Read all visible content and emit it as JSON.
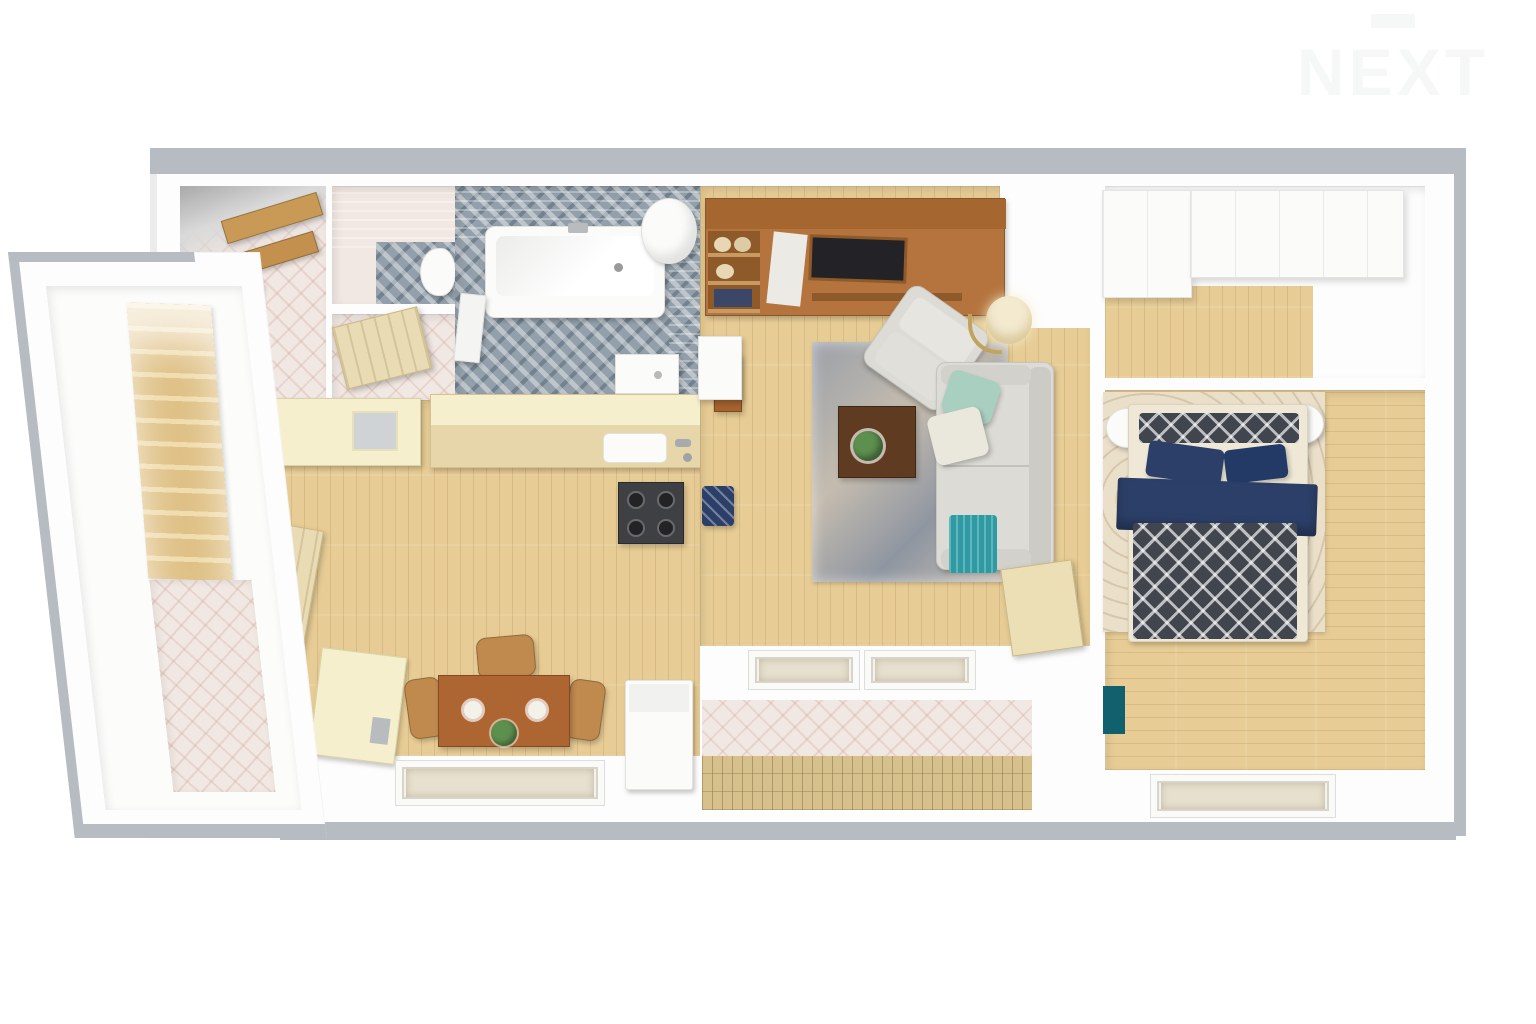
{
  "watermark": {
    "text": "NEXT"
  },
  "palette": {
    "canvas": "#ffffff",
    "wall": "#fdfdfd",
    "outer_edge": "#b6bcc1",
    "wood_floor": "#e7cc95",
    "wood_furn": "#b5743e",
    "cream_cabinet": "#f5efcd",
    "gray_tile": "#93a0ab",
    "gray_wall_tile": "#c3c9cd",
    "pink_tile": "#f2e8e3",
    "sofa_gray": "#dcdbd5",
    "mint": "#a9cfc0",
    "teal": "#2e9aa3",
    "navy": "#2c3f68",
    "dark_blanket": "#41454e",
    "rug_bedroom": "#eadfc9",
    "white_furn": "#fbfbfa",
    "lamp_glow": "#f3ead0",
    "plant_green": "#5d8f4e",
    "stove_dark": "#3f4043",
    "decking": "#d6c08b",
    "door_wood": "#e9dcb4",
    "watermark": "#f6f7f7"
  },
  "scene": {
    "type": "3d-floor-plan-render-top-down",
    "rooms": [
      {
        "id": "stair-hall",
        "label": "Staircase hall",
        "features": [
          "wooden staircase",
          "tiled landing floor"
        ]
      },
      {
        "id": "landing",
        "label": "Upstairs landing",
        "features": [
          "wooden balustrade"
        ]
      },
      {
        "id": "wc",
        "label": "WC",
        "features": [
          "toilet",
          "mosaic floor",
          "gray tiled wall"
        ]
      },
      {
        "id": "storage",
        "label": "Storage closet",
        "features": [
          "open wooden door",
          "pale tiled floor"
        ]
      },
      {
        "id": "bathroom",
        "label": "Bathroom",
        "features": [
          "bathtub",
          "round water heater",
          "shower basin",
          "gray mosaic floor",
          "white door"
        ]
      },
      {
        "id": "kitchen",
        "label": "Kitchen / dining room",
        "features": [
          "cream upper cabinets",
          "counter with sink and faucet",
          "four-burner stove",
          "wooden dining table",
          "three wicker chairs",
          "plates",
          "plant centerpiece",
          "cream fridge unit",
          "white washing machine",
          "entry door",
          "roof window"
        ]
      },
      {
        "id": "living-room",
        "label": "Living room",
        "features": [
          "wooden tv wall unit",
          "flat tv",
          "storage baskets",
          "gray sofa",
          "mint pillow",
          "cream pillow",
          "teal throw",
          "gray armchair",
          "dark coffee table with plant",
          "mottled rug",
          "floor lamp",
          "white desk with wooden chair",
          "navy pouf",
          "balcony door",
          "two roof windows"
        ]
      },
      {
        "id": "balcony",
        "label": "Balcony / loggia",
        "features": [
          "diamond tiled wall",
          "wooden decking"
        ]
      },
      {
        "id": "wardrobe",
        "label": "Walk-in closet",
        "features": [
          "white wardrobe cabinets",
          "wood floor"
        ]
      },
      {
        "id": "bedroom",
        "label": "Bedroom",
        "features": [
          "double bed",
          "patterned pillow",
          "two navy pillows",
          "navy duvet",
          "dark patterned blanket",
          "two round white nightstands",
          "cream swirl rug",
          "teal wall object",
          "roof window"
        ]
      }
    ]
  }
}
